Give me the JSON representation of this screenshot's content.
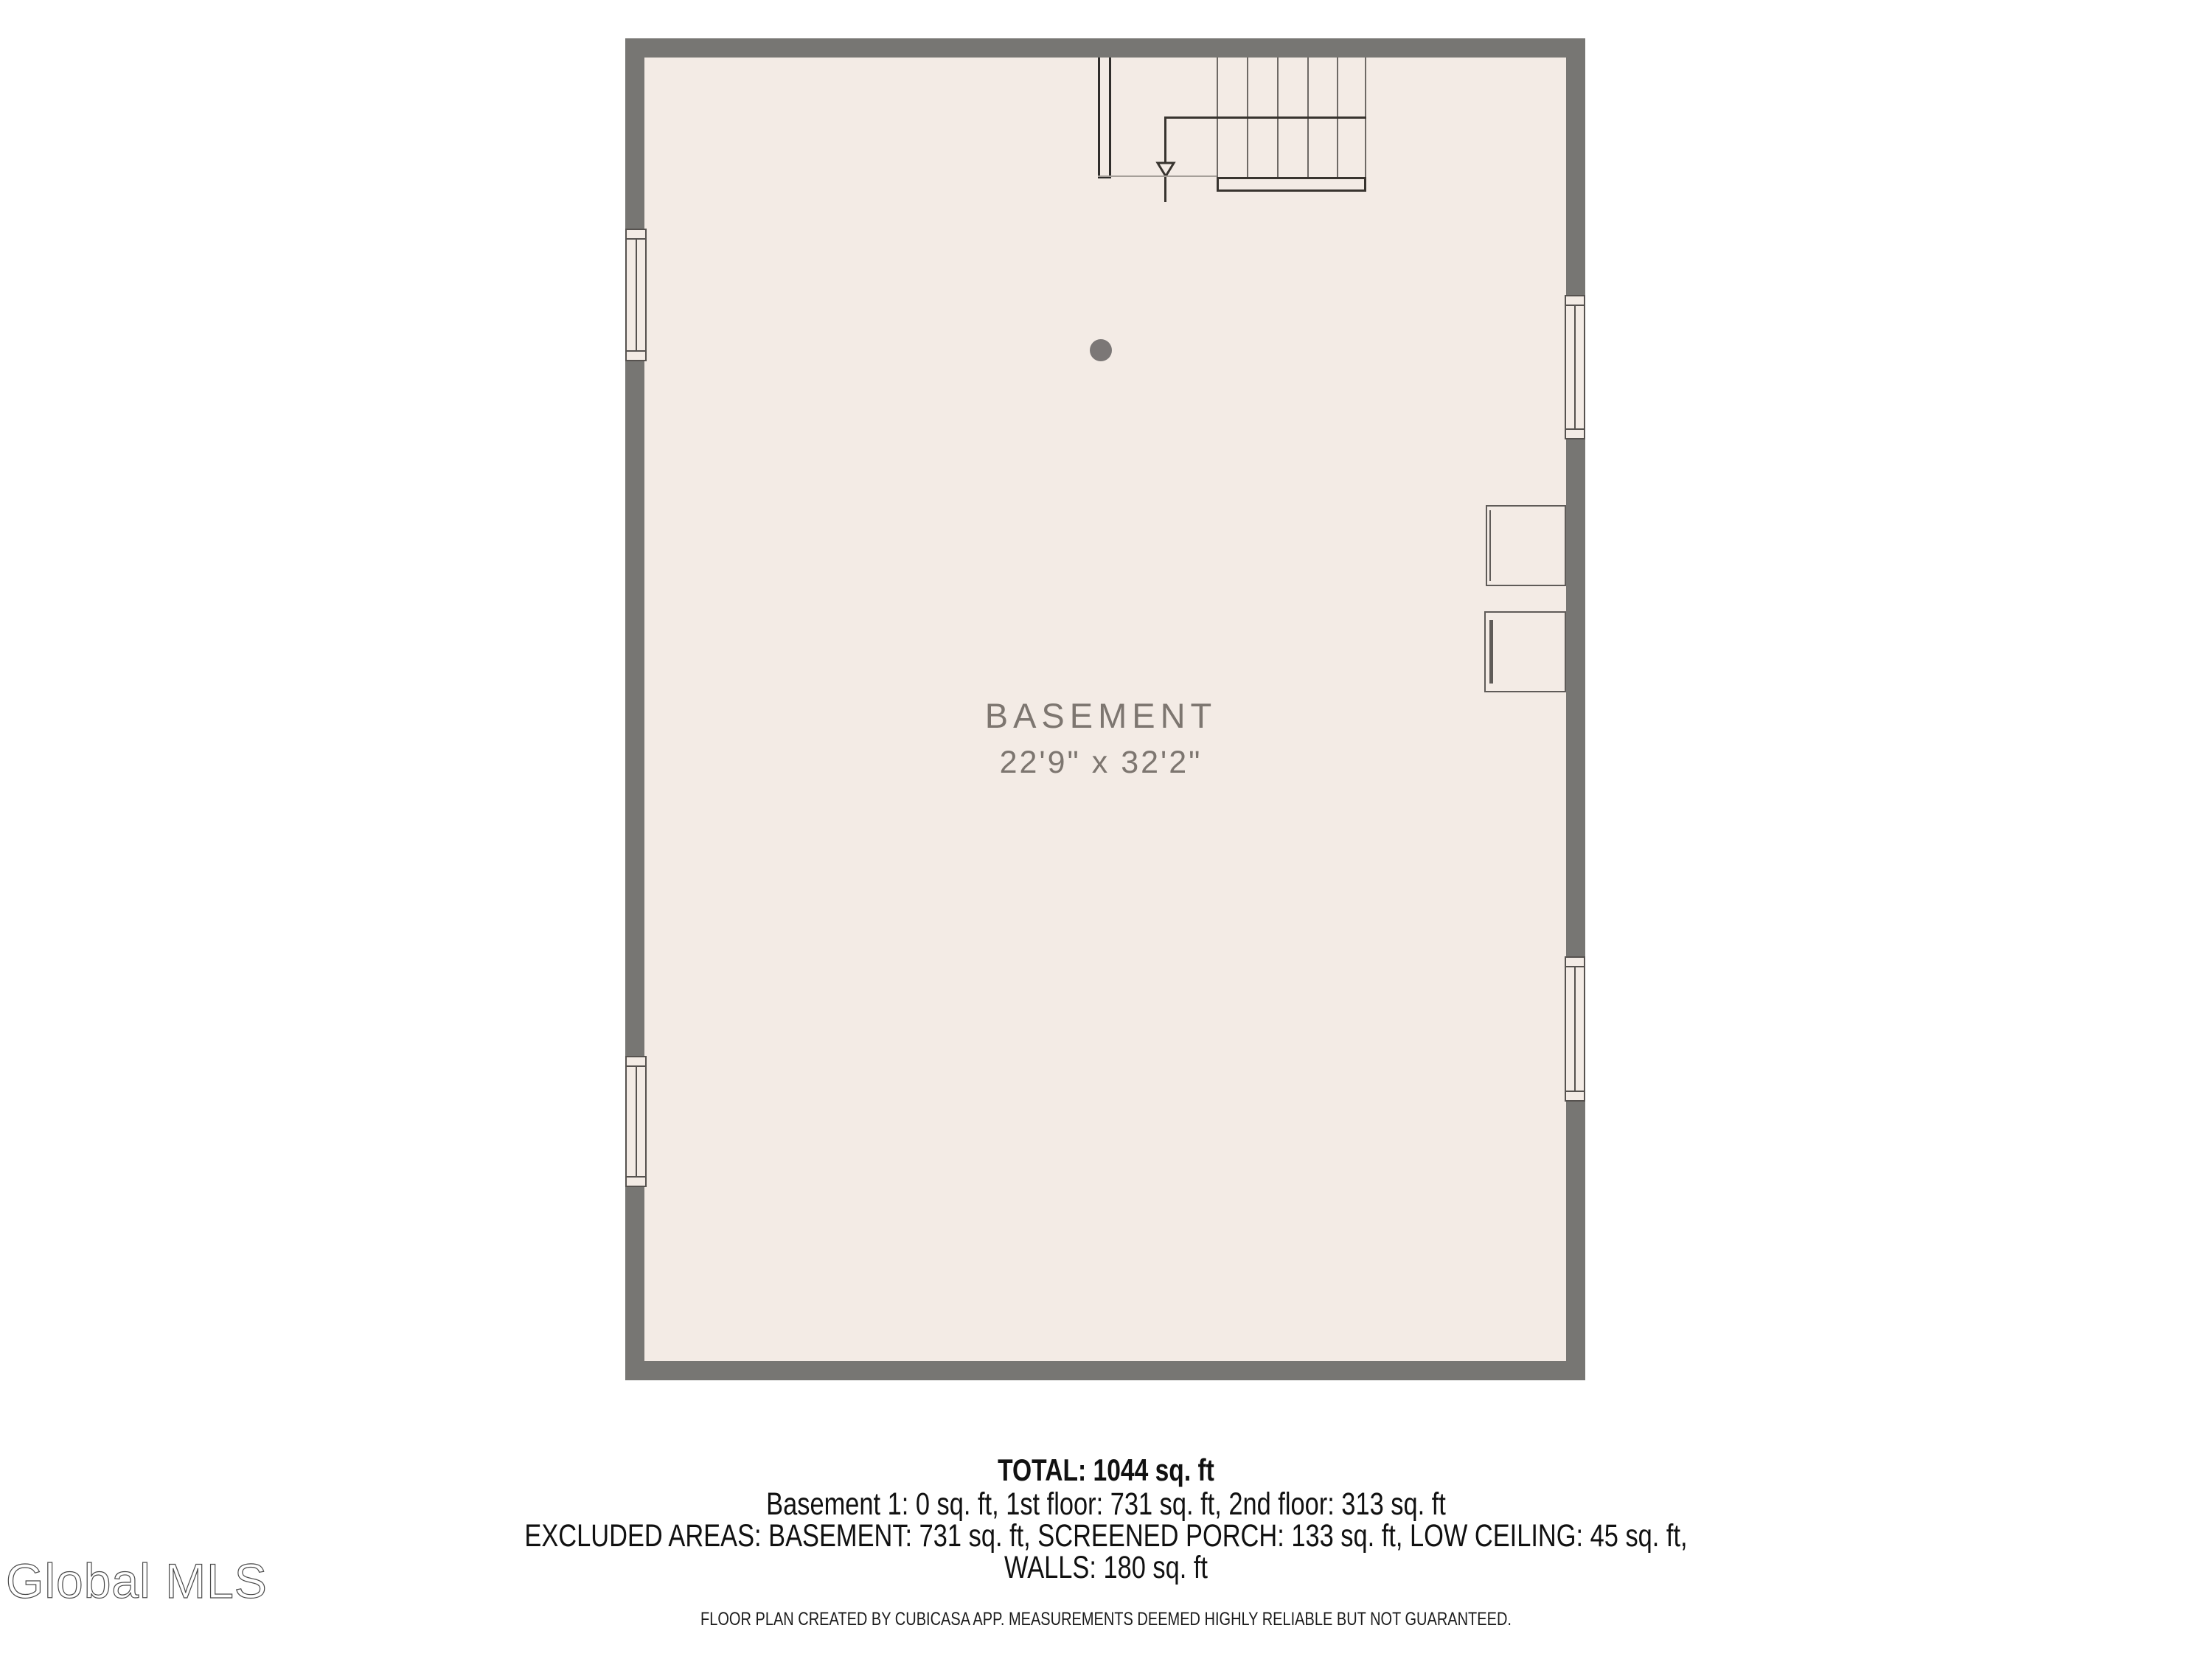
{
  "plan": {
    "room_label": "BASEMENT",
    "room_dimensions": "22'9\" x 32'2\"",
    "features": {
      "stairs": "staircase-with-down-arrow",
      "window_count": 4,
      "ceiling_light": "ceiling-light-dot",
      "appliance_count": 2
    },
    "colors": {
      "wall": "#777673",
      "floor": "#f3ebe5",
      "stair_outline": "#38342f",
      "tread_line": "#6e6965",
      "window_frame": "#56524f",
      "label_text": "#7d7670",
      "light_dot": "#7b7776"
    }
  },
  "summary": {
    "total": "TOTAL: 1044 sq. ft",
    "floors_line": "Basement 1: 0 sq. ft, 1st floor: 731 sq. ft, 2nd floor: 313 sq. ft",
    "excluded_line1": "EXCLUDED AREAS: BASEMENT: 731 sq. ft, SCREENED PORCH: 133 sq. ft, LOW CEILING: 45 sq. ft,",
    "excluded_line2": "WALLS: 180 sq. ft",
    "disclaimer": "FLOOR PLAN CREATED BY CUBICASA APP. MEASUREMENTS DEEMED HIGHLY RELIABLE BUT NOT GUARANTEED."
  },
  "watermark": {
    "text": "Global MLS"
  }
}
